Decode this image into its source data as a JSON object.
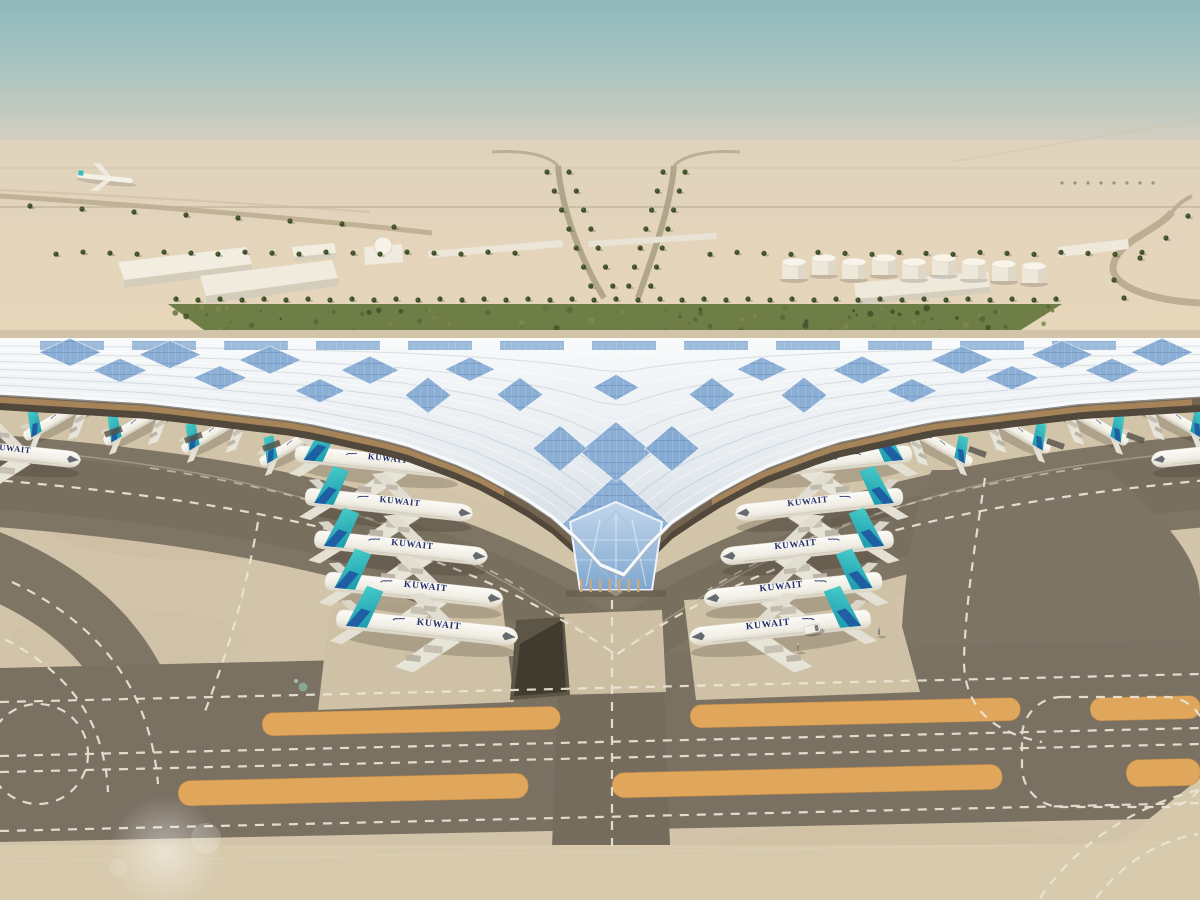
{
  "scene": {
    "subject": "Aerial architectural rendering of a desert airport terminal with a sweeping solar-panel trefoil roof",
    "setting": "desert",
    "view": "aerial"
  },
  "aircraft": {
    "airline_title": "KUWAIT",
    "front_stands_left": 5,
    "front_stands_right": 5,
    "gate_row_left": 4,
    "gate_row_right": 4,
    "edge_partial_left": 1,
    "edge_partial_right": 1
  },
  "ground_support": {
    "fuel_tanks": 9,
    "service_vans": 1,
    "ground_posts": 2
  },
  "colors": {
    "sky_top": "#8fb9bd",
    "sky_haze": "#e0d4bf",
    "desert_sand": "#e4d3b7",
    "apron_concrete": "#d2c4a9",
    "taxiway_asphalt": "#7b7163",
    "shoulder_stripe_orange": "#e0a65b",
    "taxi_marking_white": "#ece6d6",
    "roof_silver_white": "#eef2f5",
    "solar_panel_blue": "#86abd3",
    "soffit_wood_tan": "#c49a6a",
    "terminal_glass_blue": "#a8c6e4",
    "garden_green": "#6f7d46",
    "palm_green": "#3d4e28",
    "tail_teal": "#2fbfc0",
    "tail_swoosh_blue": "#1e57a0",
    "fuselage_white": "#f4f2ec",
    "livery_text_navy": "#23306b"
  }
}
